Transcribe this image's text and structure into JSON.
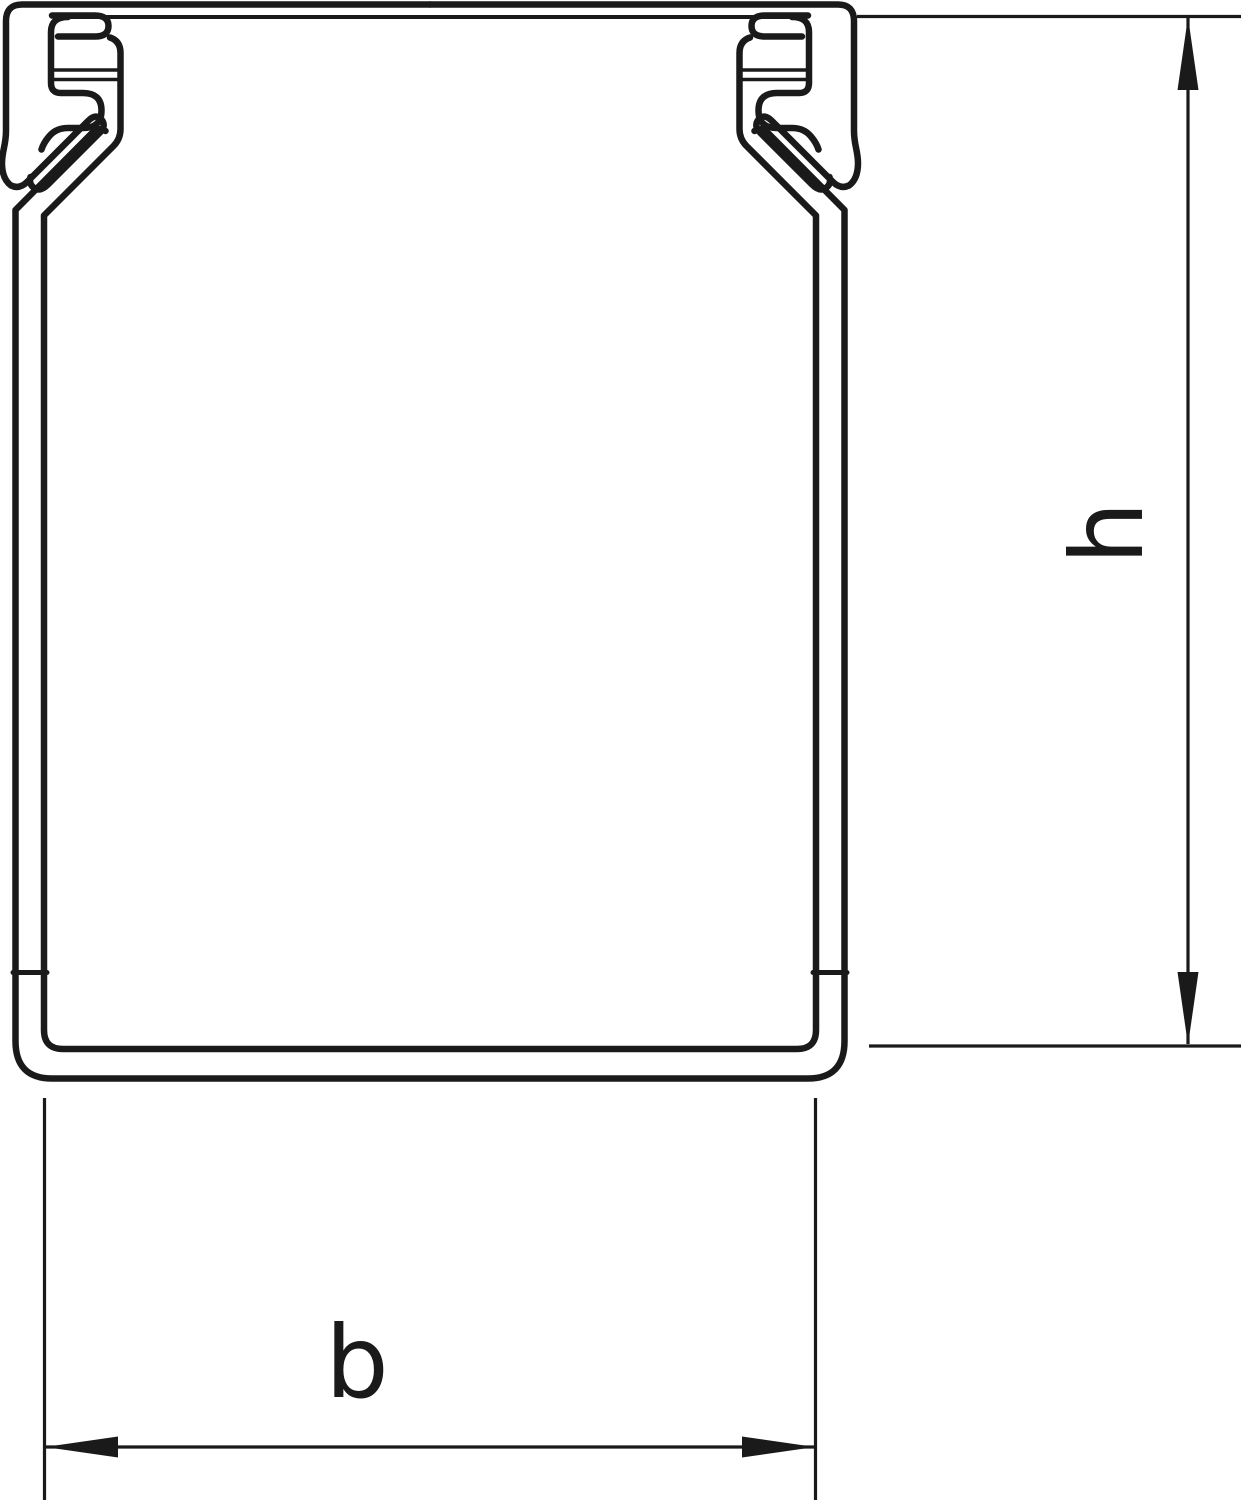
{
  "drawing": {
    "labels": {
      "height": "h",
      "width": "b"
    },
    "colors": {
      "line": "#1a1a1a",
      "background": "#ffffff"
    }
  }
}
